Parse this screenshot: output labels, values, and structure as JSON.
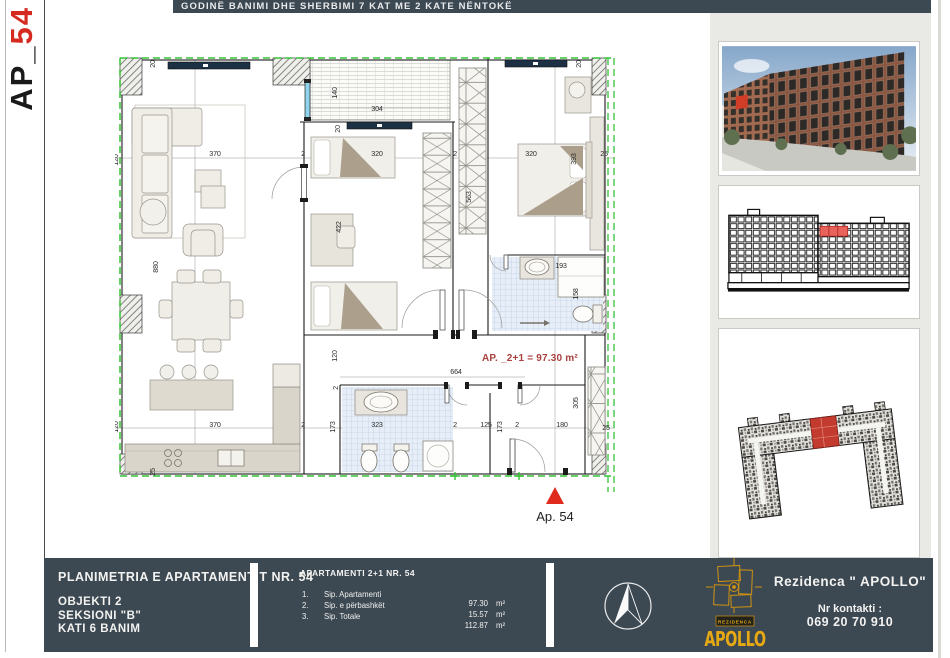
{
  "sheet": {
    "code_prefix": "AP_",
    "code_number": "54",
    "header": "GODINË BANIMI DHE SHERBIMI 7 KAT ME 2 KATE NËNTOKË"
  },
  "plan": {
    "area_note": "AP. _2+1 = 97.30 m²",
    "entrance_marker": "Ap. 54",
    "dimensions": [
      {
        "t": "20",
        "x": 40,
        "y": 44,
        "r": 1
      },
      {
        "t": "140",
        "x": 222,
        "y": 73,
        "r": 1
      },
      {
        "t": "304",
        "x": 262,
        "y": 91
      },
      {
        "t": "20",
        "x": 225,
        "y": 109,
        "r": 1
      },
      {
        "t": "20",
        "x": 466,
        "y": 44,
        "r": 1
      },
      {
        "t": "120",
        "x": 3,
        "y": 140,
        "r": 1
      },
      {
        "t": "370",
        "x": 100,
        "y": 136
      },
      {
        "t": "2",
        "x": 188,
        "y": 136
      },
      {
        "t": "320",
        "x": 262,
        "y": 136
      },
      {
        "t": "2",
        "x": 340,
        "y": 136
      },
      {
        "t": "320",
        "x": 416,
        "y": 136
      },
      {
        "t": "393",
        "x": 461,
        "y": 139,
        "r": 1
      },
      {
        "t": "25",
        "x": 489,
        "y": 136
      },
      {
        "t": "880",
        "x": 43,
        "y": 247,
        "r": 1
      },
      {
        "t": "422",
        "x": 226,
        "y": 207,
        "r": 1
      },
      {
        "t": "563",
        "x": 356,
        "y": 177,
        "r": 1
      },
      {
        "t": "193",
        "x": 446,
        "y": 248
      },
      {
        "t": "158",
        "x": 463,
        "y": 274,
        "r": 1
      },
      {
        "t": "120",
        "x": 222,
        "y": 336,
        "r": 1
      },
      {
        "t": "2",
        "x": 223,
        "y": 368,
        "r": 1
      },
      {
        "t": "664",
        "x": 341,
        "y": 354
      },
      {
        "t": "305",
        "x": 463,
        "y": 383,
        "r": 1
      },
      {
        "t": "120",
        "x": 3,
        "y": 407,
        "r": 1
      },
      {
        "t": "370",
        "x": 100,
        "y": 407
      },
      {
        "t": "2",
        "x": 188,
        "y": 407
      },
      {
        "t": "173",
        "x": 220,
        "y": 407,
        "r": 1
      },
      {
        "t": "323",
        "x": 262,
        "y": 407
      },
      {
        "t": "2",
        "x": 340,
        "y": 407
      },
      {
        "t": "125",
        "x": 371,
        "y": 407
      },
      {
        "t": "173",
        "x": 387,
        "y": 407,
        "r": 1
      },
      {
        "t": "2",
        "x": 402,
        "y": 407
      },
      {
        "t": "180",
        "x": 447,
        "y": 407
      },
      {
        "t": "25",
        "x": 491,
        "y": 410
      },
      {
        "t": "25",
        "x": 40,
        "y": 452,
        "r": 1
      }
    ]
  },
  "titleblock": {
    "plan_title": "PLANIMETRIA E APARTAMENTIT NR. 54",
    "object_line": "OBJEKTI 2",
    "section_line": "SEKSIONI \"B\"",
    "floor_line": "KATI 6 BANIM",
    "apt_header": "APARTAMENTI 2+1 NR. 54",
    "rows": [
      {
        "no": "1.",
        "label": "Sip. Apartamenti",
        "value": "97.30",
        "unit": "m²"
      },
      {
        "no": "2.",
        "label": "Sip. e përbashkët",
        "value": "15.57",
        "unit": "m²"
      },
      {
        "no": "3.",
        "label": "Sip. Totale",
        "value": "112.87",
        "unit": "m²"
      }
    ],
    "brand_name": "Rezidenca \" APOLLO\"",
    "contact_label": "Nr kontakti :",
    "phone": "069 20 70 910",
    "logo_banner": "REZIDENCA",
    "logo_word": "APOLLO"
  },
  "colors": {
    "bar": "#3c4852",
    "boundary_green": "#35c435",
    "accent_red": "#d42a20",
    "window_navy": "#1d3145",
    "logo_gold": "#e7a912"
  }
}
